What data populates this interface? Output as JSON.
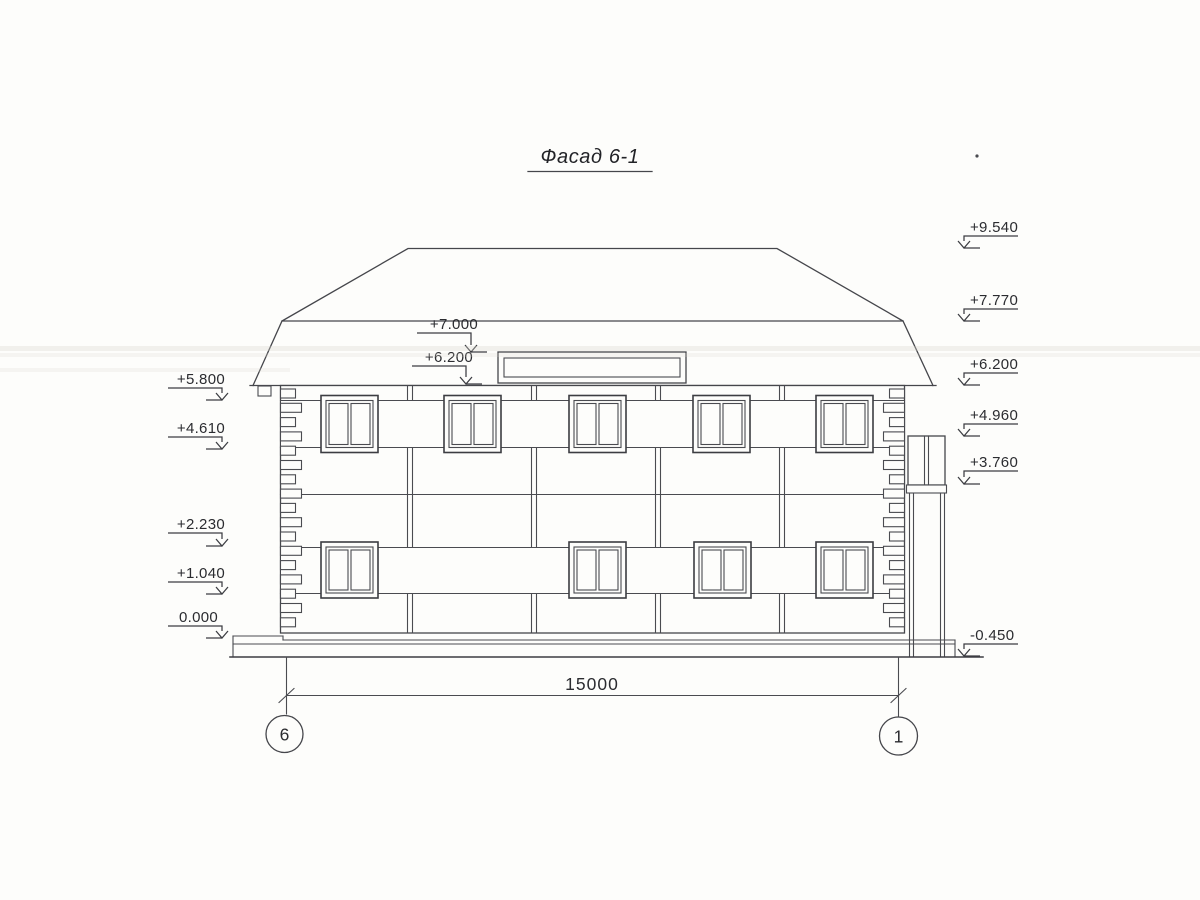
{
  "drawing": {
    "title": "Фасад 6-1",
    "dimension_label": "15000",
    "axis_labels": {
      "left": "6",
      "right": "1"
    },
    "elevation_marks": {
      "left": [
        "+5.800",
        "+4.610",
        "+2.230",
        "+1.040",
        "0.000"
      ],
      "right": [
        "+9.540",
        "+7.770",
        "+6.200",
        "+4.960",
        "+3.760",
        "-0.450"
      ],
      "roof": [
        "+7.000",
        "+6.200"
      ]
    },
    "colors": {
      "line": "#45464b",
      "background": "#fdfdfb"
    }
  }
}
